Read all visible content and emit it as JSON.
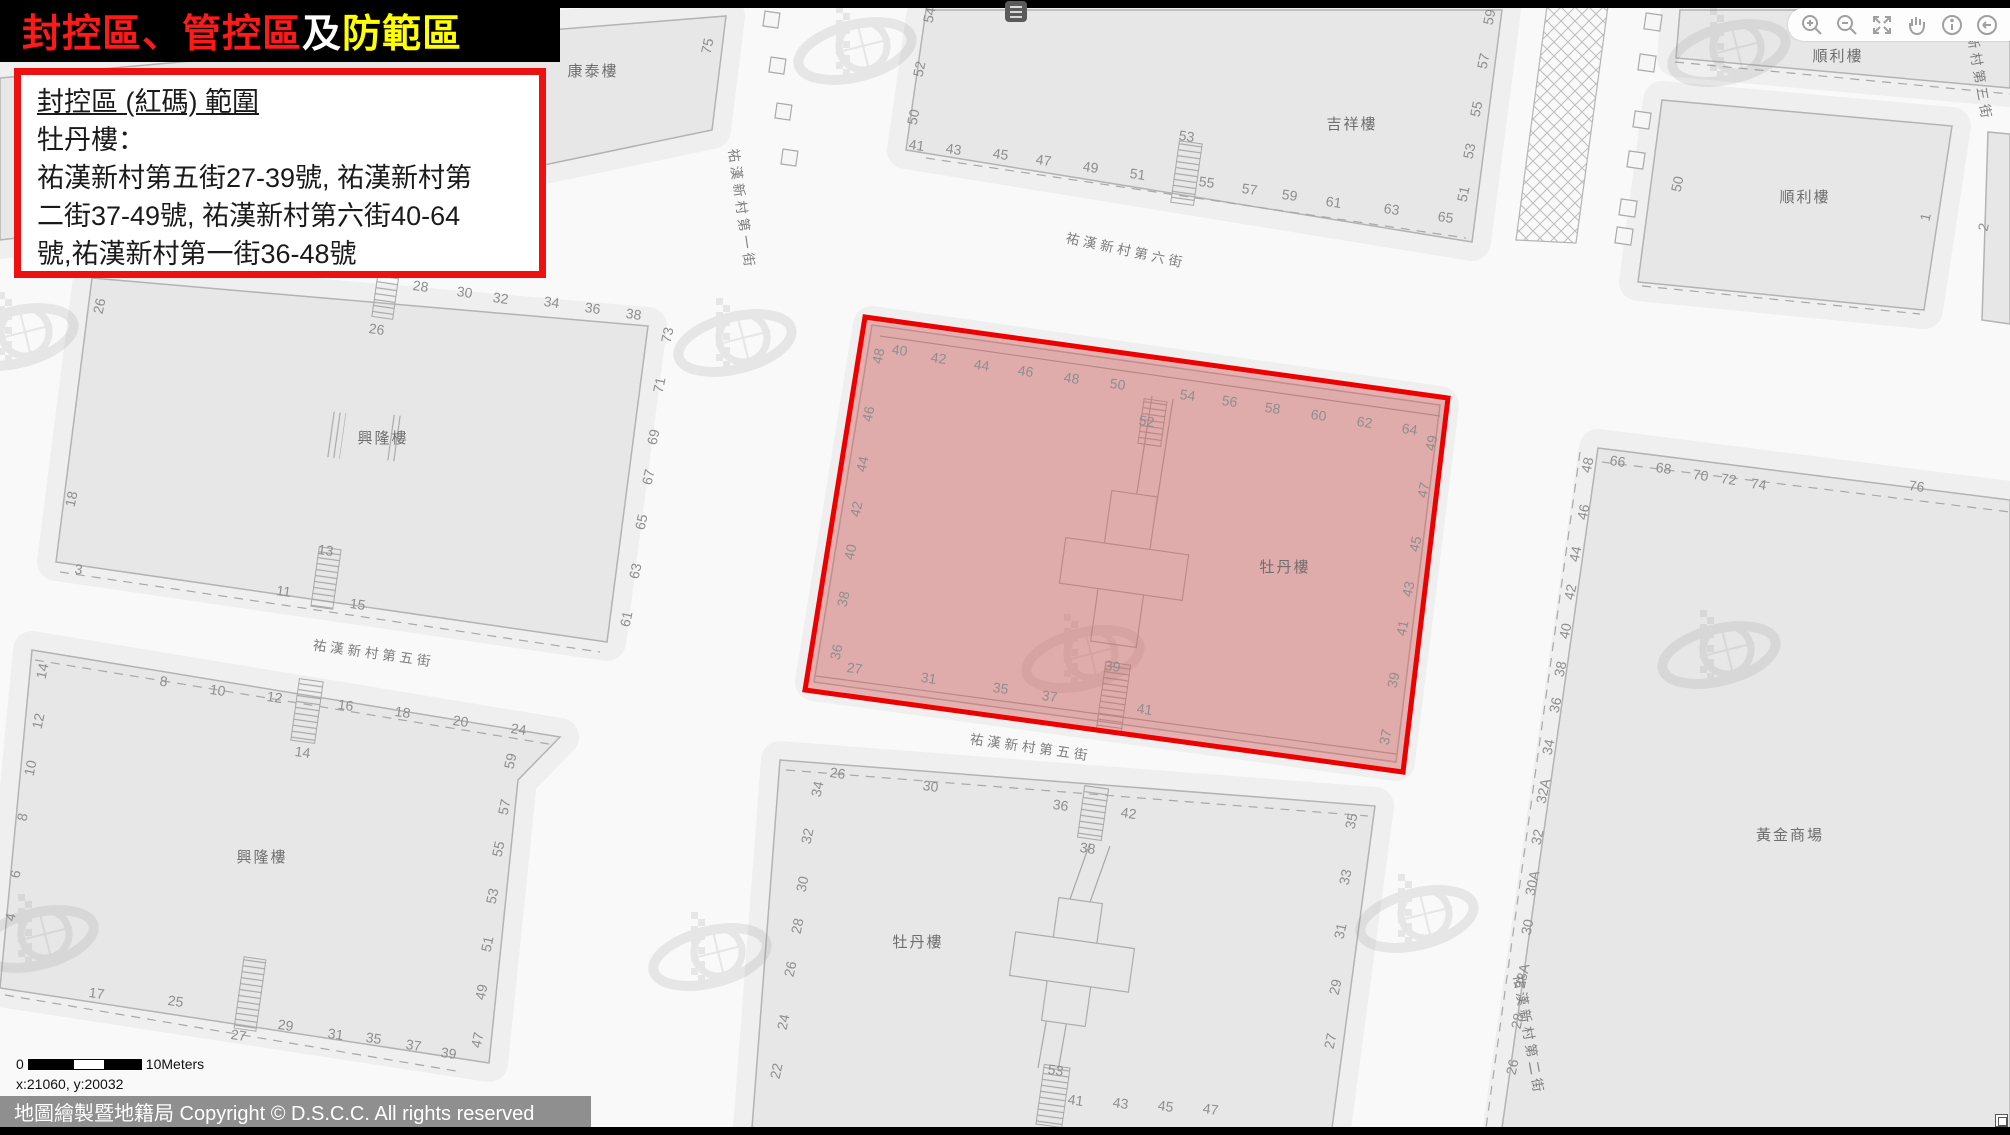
{
  "title": {
    "red": "封控區、管控區",
    "white": "及",
    "yellow": "防範區"
  },
  "info_box": {
    "heading": "封控區 (紅碼) 範圍",
    "subject": "牡丹樓：",
    "body_lines": [
      "祐漢新村第五街27-39號, 祐漢新村第",
      "二街37-49號, 祐漢新村第六街40-64",
      "號,祐漢新村第一街36-48號"
    ]
  },
  "toolbar": {
    "icons": [
      "zoom-in",
      "zoom-out",
      "fullscreen",
      "pan-hand",
      "info",
      "back",
      "forward"
    ]
  },
  "scale_bar": {
    "zero": "0",
    "label": "10Meters"
  },
  "coordinates": "x:21060, y:20032",
  "copyright": "地圖繪製暨地籍局 Copyright © D.S.C.C. All rights reserved",
  "red_zone": {
    "points": "865,317 1448,398 1403,772 805,690",
    "fill": "rgba(214,88,88,0.42)",
    "stroke": "#ec0000"
  },
  "map": {
    "labels": [
      {
        "t": "康泰樓",
        "x": 593,
        "y": 76,
        "r": 0,
        "k": "bldg"
      },
      {
        "t": "吉祥樓",
        "x": 1352,
        "y": 129,
        "r": 0,
        "k": "bldg"
      },
      {
        "t": "順利樓",
        "x": 1838,
        "y": 61,
        "r": 0,
        "k": "bldg"
      },
      {
        "t": "順利樓",
        "x": 1805,
        "y": 202,
        "r": 0,
        "k": "bldg"
      },
      {
        "t": "興隆樓",
        "x": 383,
        "y": 443,
        "r": 0,
        "k": "bldg"
      },
      {
        "t": "興隆樓",
        "x": 262,
        "y": 862,
        "r": 0,
        "k": "bldg"
      },
      {
        "t": "牡丹樓",
        "x": 1285,
        "y": 572,
        "r": 0,
        "k": "bldg"
      },
      {
        "t": "牡丹樓",
        "x": 918,
        "y": 947,
        "r": 0,
        "k": "bldg"
      },
      {
        "t": "黃金商場",
        "x": 1790,
        "y": 840,
        "r": 0,
        "k": "bldg"
      },
      {
        "t": "祐漢新村第五街",
        "x": 373,
        "y": 658,
        "r": 8,
        "k": "street"
      },
      {
        "t": "祐漢新村第五街",
        "x": 1030,
        "y": 752,
        "r": 8,
        "k": "street"
      },
      {
        "t": "祐漢新村第六街",
        "x": 1125,
        "y": 255,
        "r": 12,
        "k": "street"
      },
      {
        "t": "祐漢新村第一街",
        "x": 737,
        "y": 210,
        "r": 82,
        "k": "street"
      },
      {
        "t": "祐漢新村第三街",
        "x": 1972,
        "y": 62,
        "r": 80,
        "k": "street"
      },
      {
        "t": "祐漢新村第二街",
        "x": 1524,
        "y": 1036,
        "r": 80,
        "k": "street"
      },
      {
        "t": "75",
        "x": 712,
        "y": 47,
        "r": -78,
        "k": "num"
      },
      {
        "t": "54",
        "x": 934,
        "y": 16,
        "r": -78,
        "k": "num"
      },
      {
        "t": "52",
        "x": 924,
        "y": 70,
        "r": -78,
        "k": "num"
      },
      {
        "t": "50",
        "x": 918,
        "y": 118,
        "r": -78,
        "k": "num"
      },
      {
        "t": "41",
        "x": 916,
        "y": 150,
        "r": 8,
        "k": "num"
      },
      {
        "t": "43",
        "x": 953,
        "y": 154,
        "r": 8,
        "k": "num"
      },
      {
        "t": "45",
        "x": 1000,
        "y": 159,
        "r": 8,
        "k": "num"
      },
      {
        "t": "47",
        "x": 1043,
        "y": 165,
        "r": 8,
        "k": "num"
      },
      {
        "t": "49",
        "x": 1090,
        "y": 172,
        "r": 8,
        "k": "num"
      },
      {
        "t": "51",
        "x": 1137,
        "y": 179,
        "r": 8,
        "k": "num"
      },
      {
        "t": "53",
        "x": 1186,
        "y": 141,
        "r": 8,
        "k": "num"
      },
      {
        "t": "55",
        "x": 1206,
        "y": 187,
        "r": 8,
        "k": "num"
      },
      {
        "t": "57",
        "x": 1249,
        "y": 194,
        "r": 8,
        "k": "num"
      },
      {
        "t": "59",
        "x": 1289,
        "y": 200,
        "r": 8,
        "k": "num"
      },
      {
        "t": "61",
        "x": 1333,
        "y": 207,
        "r": 8,
        "k": "num"
      },
      {
        "t": "63",
        "x": 1391,
        "y": 214,
        "r": 8,
        "k": "num"
      },
      {
        "t": "65",
        "x": 1445,
        "y": 222,
        "r": 8,
        "k": "num"
      },
      {
        "t": "59",
        "x": 1494,
        "y": 18,
        "r": -78,
        "k": "num"
      },
      {
        "t": "57",
        "x": 1488,
        "y": 62,
        "r": -78,
        "k": "num"
      },
      {
        "t": "55",
        "x": 1481,
        "y": 110,
        "r": -78,
        "k": "num"
      },
      {
        "t": "53",
        "x": 1474,
        "y": 152,
        "r": -78,
        "k": "num"
      },
      {
        "t": "51",
        "x": 1468,
        "y": 195,
        "r": -78,
        "k": "num"
      },
      {
        "t": "50",
        "x": 1682,
        "y": 185,
        "r": -78,
        "k": "num"
      },
      {
        "t": "1",
        "x": 1930,
        "y": 218,
        "r": -78,
        "k": "num"
      },
      {
        "t": "2",
        "x": 1988,
        "y": 228,
        "r": -78,
        "k": "num"
      },
      {
        "t": "26",
        "x": 104,
        "y": 307,
        "r": -78,
        "k": "num"
      },
      {
        "t": "28",
        "x": 420,
        "y": 291,
        "r": 8,
        "k": "num"
      },
      {
        "t": "30",
        "x": 464,
        "y": 297,
        "r": 8,
        "k": "num"
      },
      {
        "t": "32",
        "x": 500,
        "y": 303,
        "r": 8,
        "k": "num"
      },
      {
        "t": "34",
        "x": 551,
        "y": 307,
        "r": 8,
        "k": "num"
      },
      {
        "t": "36",
        "x": 592,
        "y": 313,
        "r": 8,
        "k": "num"
      },
      {
        "t": "38",
        "x": 633,
        "y": 319,
        "r": 8,
        "k": "num"
      },
      {
        "t": "26",
        "x": 376,
        "y": 334,
        "r": 8,
        "k": "num"
      },
      {
        "t": "73",
        "x": 672,
        "y": 336,
        "r": -78,
        "k": "num"
      },
      {
        "t": "71",
        "x": 664,
        "y": 386,
        "r": -78,
        "k": "num"
      },
      {
        "t": "69",
        "x": 658,
        "y": 438,
        "r": -78,
        "k": "num"
      },
      {
        "t": "67",
        "x": 653,
        "y": 478,
        "r": -78,
        "k": "num"
      },
      {
        "t": "65",
        "x": 646,
        "y": 523,
        "r": -78,
        "k": "num"
      },
      {
        "t": "63",
        "x": 640,
        "y": 572,
        "r": -78,
        "k": "num"
      },
      {
        "t": "61",
        "x": 631,
        "y": 620,
        "r": -78,
        "k": "num"
      },
      {
        "t": "18",
        "x": 76,
        "y": 500,
        "r": -78,
        "k": "num"
      },
      {
        "t": "3",
        "x": 78,
        "y": 574,
        "r": 8,
        "k": "num"
      },
      {
        "t": "13",
        "x": 325,
        "y": 555,
        "r": 8,
        "k": "num"
      },
      {
        "t": "11",
        "x": 283,
        "y": 596,
        "r": 8,
        "k": "num"
      },
      {
        "t": "15",
        "x": 357,
        "y": 609,
        "r": 8,
        "k": "num"
      },
      {
        "t": "14",
        "x": 47,
        "y": 672,
        "r": -78,
        "k": "num"
      },
      {
        "t": "12",
        "x": 43,
        "y": 722,
        "r": -78,
        "k": "num"
      },
      {
        "t": "10",
        "x": 35,
        "y": 769,
        "r": -78,
        "k": "num"
      },
      {
        "t": "8",
        "x": 27,
        "y": 818,
        "r": -78,
        "k": "num"
      },
      {
        "t": "6",
        "x": 20,
        "y": 875,
        "r": -78,
        "k": "num"
      },
      {
        "t": "4",
        "x": 15,
        "y": 918,
        "r": -78,
        "k": "num"
      },
      {
        "t": "8",
        "x": 163,
        "y": 686,
        "r": 8,
        "k": "num"
      },
      {
        "t": "10",
        "x": 217,
        "y": 695,
        "r": 8,
        "k": "num"
      },
      {
        "t": "12",
        "x": 274,
        "y": 702,
        "r": 8,
        "k": "num"
      },
      {
        "t": "16",
        "x": 345,
        "y": 710,
        "r": 8,
        "k": "num"
      },
      {
        "t": "18",
        "x": 402,
        "y": 717,
        "r": 8,
        "k": "num"
      },
      {
        "t": "20",
        "x": 460,
        "y": 726,
        "r": 8,
        "k": "num"
      },
      {
        "t": "24",
        "x": 518,
        "y": 734,
        "r": 8,
        "k": "num"
      },
      {
        "t": "14",
        "x": 302,
        "y": 757,
        "r": 8,
        "k": "num"
      },
      {
        "t": "17",
        "x": 96,
        "y": 998,
        "r": 8,
        "k": "num"
      },
      {
        "t": "25",
        "x": 175,
        "y": 1006,
        "r": 8,
        "k": "num"
      },
      {
        "t": "27",
        "x": 238,
        "y": 1040,
        "r": 8,
        "k": "num"
      },
      {
        "t": "29",
        "x": 285,
        "y": 1030,
        "r": 8,
        "k": "num"
      },
      {
        "t": "31",
        "x": 335,
        "y": 1039,
        "r": 8,
        "k": "num"
      },
      {
        "t": "35",
        "x": 373,
        "y": 1043,
        "r": 8,
        "k": "num"
      },
      {
        "t": "37",
        "x": 413,
        "y": 1050,
        "r": 8,
        "k": "num"
      },
      {
        "t": "39",
        "x": 448,
        "y": 1058,
        "r": 8,
        "k": "num"
      },
      {
        "t": "59",
        "x": 515,
        "y": 762,
        "r": -78,
        "k": "num"
      },
      {
        "t": "57",
        "x": 509,
        "y": 808,
        "r": -78,
        "k": "num"
      },
      {
        "t": "55",
        "x": 503,
        "y": 850,
        "r": -78,
        "k": "num"
      },
      {
        "t": "53",
        "x": 497,
        "y": 897,
        "r": -78,
        "k": "num"
      },
      {
        "t": "51",
        "x": 492,
        "y": 945,
        "r": -78,
        "k": "num"
      },
      {
        "t": "49",
        "x": 486,
        "y": 993,
        "r": -78,
        "k": "num"
      },
      {
        "t": "47",
        "x": 482,
        "y": 1041,
        "r": -78,
        "k": "num"
      },
      {
        "t": "48",
        "x": 883,
        "y": 357,
        "r": -78,
        "k": "num"
      },
      {
        "t": "40",
        "x": 899,
        "y": 355,
        "r": 8,
        "k": "num"
      },
      {
        "t": "42",
        "x": 938,
        "y": 363,
        "r": 8,
        "k": "num"
      },
      {
        "t": "44",
        "x": 981,
        "y": 370,
        "r": 8,
        "k": "num"
      },
      {
        "t": "46",
        "x": 1025,
        "y": 376,
        "r": 8,
        "k": "num"
      },
      {
        "t": "48",
        "x": 1071,
        "y": 383,
        "r": 8,
        "k": "num"
      },
      {
        "t": "50",
        "x": 1117,
        "y": 389,
        "r": 8,
        "k": "num"
      },
      {
        "t": "52",
        "x": 1146,
        "y": 426,
        "r": 8,
        "k": "num"
      },
      {
        "t": "54",
        "x": 1187,
        "y": 400,
        "r": 8,
        "k": "num"
      },
      {
        "t": "56",
        "x": 1229,
        "y": 406,
        "r": 8,
        "k": "num"
      },
      {
        "t": "58",
        "x": 1272,
        "y": 413,
        "r": 8,
        "k": "num"
      },
      {
        "t": "60",
        "x": 1318,
        "y": 420,
        "r": 8,
        "k": "num"
      },
      {
        "t": "62",
        "x": 1364,
        "y": 427,
        "r": 8,
        "k": "num"
      },
      {
        "t": "64",
        "x": 1409,
        "y": 434,
        "r": 8,
        "k": "num"
      },
      {
        "t": "49",
        "x": 1436,
        "y": 444,
        "r": -78,
        "k": "num"
      },
      {
        "t": "47",
        "x": 1428,
        "y": 491,
        "r": -78,
        "k": "num"
      },
      {
        "t": "45",
        "x": 1420,
        "y": 545,
        "r": -78,
        "k": "num"
      },
      {
        "t": "43",
        "x": 1413,
        "y": 590,
        "r": -78,
        "k": "num"
      },
      {
        "t": "41",
        "x": 1407,
        "y": 629,
        "r": -78,
        "k": "num"
      },
      {
        "t": "39",
        "x": 1398,
        "y": 681,
        "r": -78,
        "k": "num"
      },
      {
        "t": "37",
        "x": 1390,
        "y": 738,
        "r": -78,
        "k": "num"
      },
      {
        "t": "46",
        "x": 873,
        "y": 415,
        "r": -78,
        "k": "num"
      },
      {
        "t": "44",
        "x": 867,
        "y": 465,
        "r": -78,
        "k": "num"
      },
      {
        "t": "42",
        "x": 861,
        "y": 510,
        "r": -78,
        "k": "num"
      },
      {
        "t": "40",
        "x": 855,
        "y": 553,
        "r": -78,
        "k": "num"
      },
      {
        "t": "38",
        "x": 848,
        "y": 600,
        "r": -78,
        "k": "num"
      },
      {
        "t": "36",
        "x": 841,
        "y": 653,
        "r": -78,
        "k": "num"
      },
      {
        "t": "27",
        "x": 854,
        "y": 673,
        "r": 8,
        "k": "num"
      },
      {
        "t": "31",
        "x": 928,
        "y": 683,
        "r": 8,
        "k": "num"
      },
      {
        "t": "35",
        "x": 1000,
        "y": 693,
        "r": 8,
        "k": "num"
      },
      {
        "t": "37",
        "x": 1049,
        "y": 701,
        "r": 8,
        "k": "num"
      },
      {
        "t": "39",
        "x": 1112,
        "y": 671,
        "r": 8,
        "k": "num"
      },
      {
        "t": "41",
        "x": 1144,
        "y": 714,
        "r": 8,
        "k": "num"
      },
      {
        "t": "26",
        "x": 837,
        "y": 778,
        "r": 8,
        "k": "num"
      },
      {
        "t": "34",
        "x": 822,
        "y": 790,
        "r": -78,
        "k": "num"
      },
      {
        "t": "30",
        "x": 930,
        "y": 791,
        "r": 8,
        "k": "num"
      },
      {
        "t": "36",
        "x": 1060,
        "y": 810,
        "r": 8,
        "k": "num"
      },
      {
        "t": "42",
        "x": 1128,
        "y": 818,
        "r": 8,
        "k": "num"
      },
      {
        "t": "32",
        "x": 812,
        "y": 837,
        "r": -78,
        "k": "num"
      },
      {
        "t": "38",
        "x": 1087,
        "y": 853,
        "r": 8,
        "k": "num"
      },
      {
        "t": "30",
        "x": 807,
        "y": 885,
        "r": -78,
        "k": "num"
      },
      {
        "t": "28",
        "x": 802,
        "y": 927,
        "r": -78,
        "k": "num"
      },
      {
        "t": "26",
        "x": 795,
        "y": 970,
        "r": -78,
        "k": "num"
      },
      {
        "t": "24",
        "x": 788,
        "y": 1023,
        "r": -78,
        "k": "num"
      },
      {
        "t": "22",
        "x": 781,
        "y": 1072,
        "r": -78,
        "k": "num"
      },
      {
        "t": "53",
        "x": 1055,
        "y": 1075,
        "r": 8,
        "k": "num"
      },
      {
        "t": "41",
        "x": 1075,
        "y": 1105,
        "r": 8,
        "k": "num"
      },
      {
        "t": "43",
        "x": 1120,
        "y": 1108,
        "r": 8,
        "k": "num"
      },
      {
        "t": "45",
        "x": 1165,
        "y": 1111,
        "r": 8,
        "k": "num"
      },
      {
        "t": "47",
        "x": 1210,
        "y": 1114,
        "r": 8,
        "k": "num"
      },
      {
        "t": "35",
        "x": 1356,
        "y": 822,
        "r": -78,
        "k": "num"
      },
      {
        "t": "33",
        "x": 1350,
        "y": 878,
        "r": -78,
        "k": "num"
      },
      {
        "t": "31",
        "x": 1345,
        "y": 932,
        "r": -78,
        "k": "num"
      },
      {
        "t": "29",
        "x": 1340,
        "y": 988,
        "r": -78,
        "k": "num"
      },
      {
        "t": "27",
        "x": 1335,
        "y": 1042,
        "r": -78,
        "k": "num"
      },
      {
        "t": "48",
        "x": 1592,
        "y": 466,
        "r": -78,
        "k": "num"
      },
      {
        "t": "66",
        "x": 1617,
        "y": 466,
        "r": 8,
        "k": "num"
      },
      {
        "t": "68",
        "x": 1663,
        "y": 473,
        "r": 8,
        "k": "num"
      },
      {
        "t": "70",
        "x": 1700,
        "y": 480,
        "r": 8,
        "k": "num"
      },
      {
        "t": "72",
        "x": 1728,
        "y": 484,
        "r": 8,
        "k": "num"
      },
      {
        "t": "74",
        "x": 1758,
        "y": 489,
        "r": 8,
        "k": "num"
      },
      {
        "t": "76",
        "x": 1916,
        "y": 491,
        "r": 8,
        "k": "num"
      },
      {
        "t": "46",
        "x": 1588,
        "y": 513,
        "r": -78,
        "k": "num"
      },
      {
        "t": "44",
        "x": 1580,
        "y": 555,
        "r": -78,
        "k": "num"
      },
      {
        "t": "42",
        "x": 1575,
        "y": 593,
        "r": -78,
        "k": "num"
      },
      {
        "t": "40",
        "x": 1570,
        "y": 632,
        "r": -78,
        "k": "num"
      },
      {
        "t": "38",
        "x": 1565,
        "y": 670,
        "r": -78,
        "k": "num"
      },
      {
        "t": "36",
        "x": 1560,
        "y": 706,
        "r": -78,
        "k": "num"
      },
      {
        "t": "34",
        "x": 1553,
        "y": 748,
        "r": -78,
        "k": "num"
      },
      {
        "t": "32A",
        "x": 1548,
        "y": 792,
        "r": -78,
        "k": "num"
      },
      {
        "t": "32",
        "x": 1542,
        "y": 838,
        "r": -78,
        "k": "num"
      },
      {
        "t": "30A",
        "x": 1537,
        "y": 884,
        "r": -78,
        "k": "num"
      },
      {
        "t": "30",
        "x": 1532,
        "y": 928,
        "r": -78,
        "k": "num"
      },
      {
        "t": "28A",
        "x": 1527,
        "y": 977,
        "r": -78,
        "k": "num"
      },
      {
        "t": "28",
        "x": 1522,
        "y": 1022,
        "r": -78,
        "k": "num"
      },
      {
        "t": "26",
        "x": 1517,
        "y": 1068,
        "r": -78,
        "k": "num"
      }
    ]
  }
}
